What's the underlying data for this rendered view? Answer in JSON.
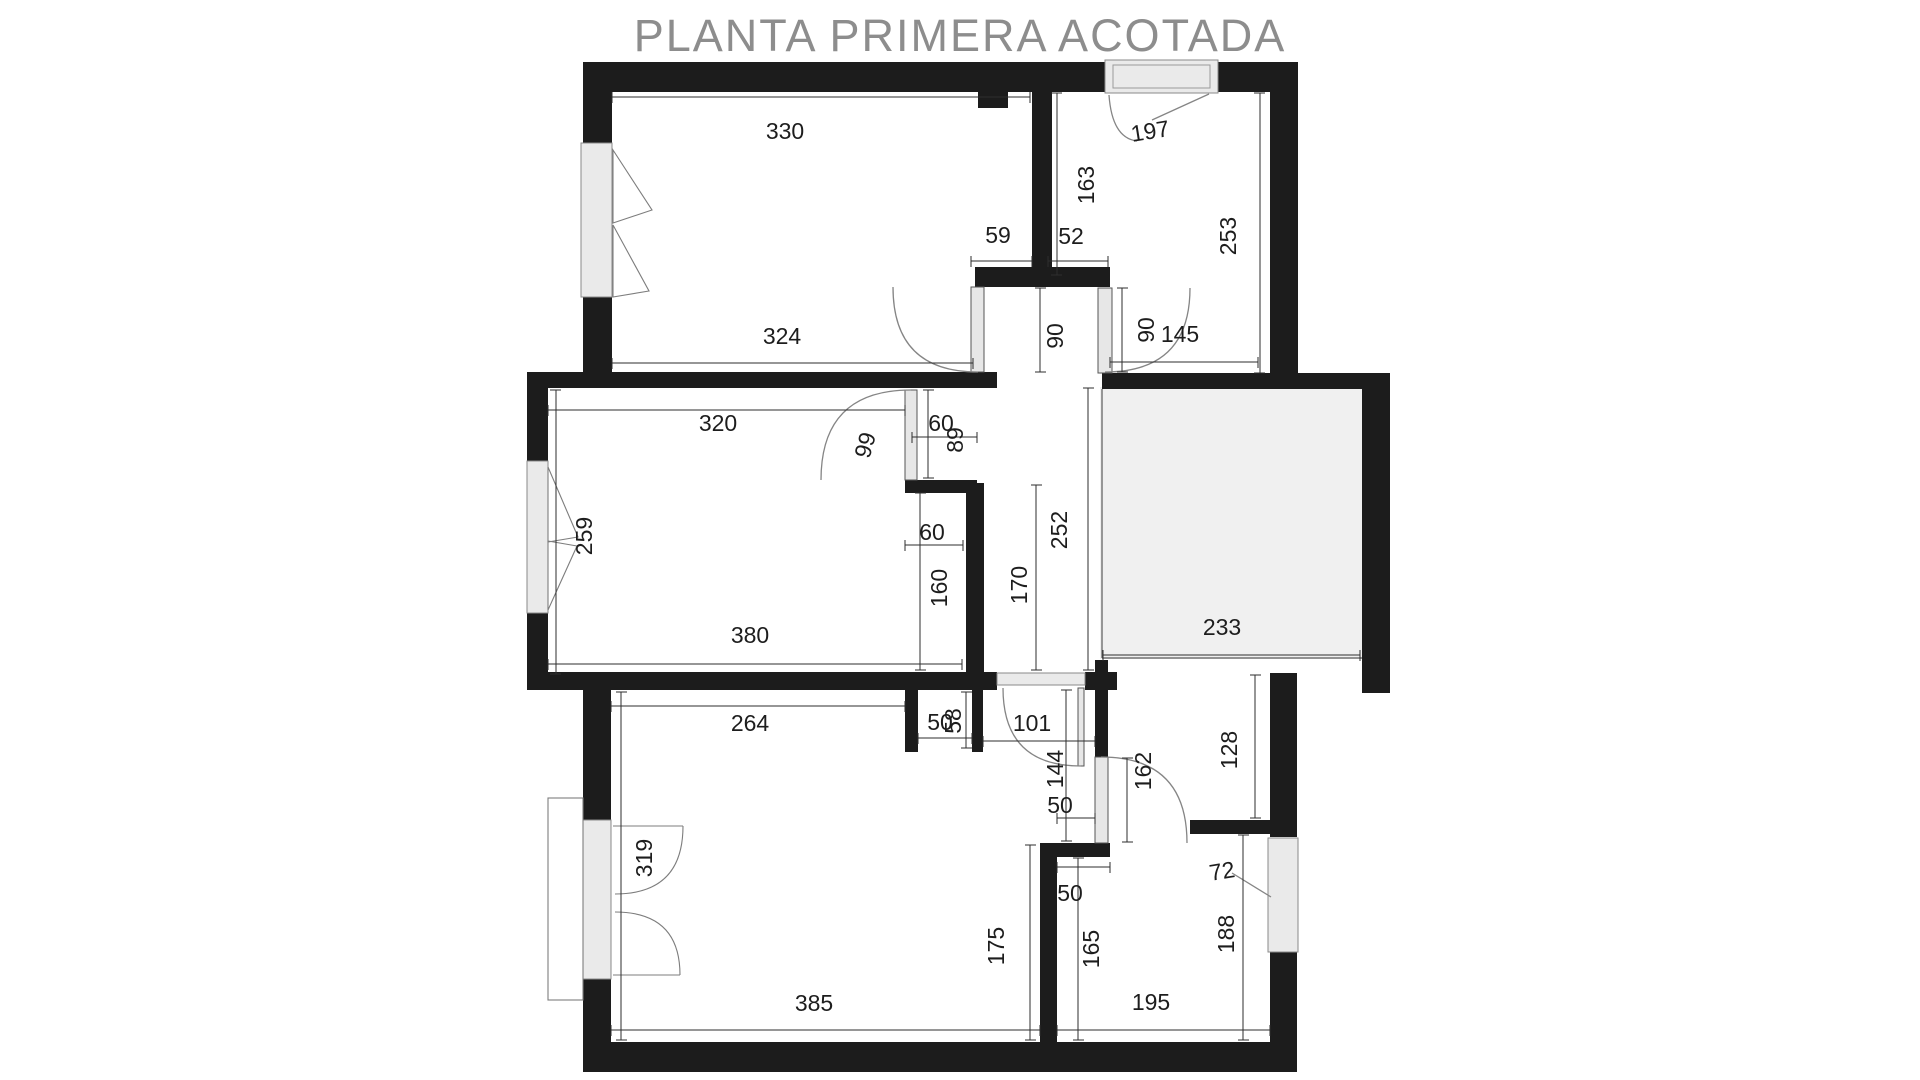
{
  "title": "PLANTA PRIMERA ACOTADA",
  "floorplan": {
    "unit": "cm",
    "labels": [
      {
        "value": "330"
      },
      {
        "value": "197"
      },
      {
        "value": "163"
      },
      {
        "value": "253"
      },
      {
        "value": "59"
      },
      {
        "value": "52"
      },
      {
        "value": "324"
      },
      {
        "value": "90"
      },
      {
        "value": "90"
      },
      {
        "value": "145"
      },
      {
        "value": "320"
      },
      {
        "value": "99"
      },
      {
        "value": "60"
      },
      {
        "value": "89"
      },
      {
        "value": "259"
      },
      {
        "value": "60"
      },
      {
        "value": "160"
      },
      {
        "value": "170"
      },
      {
        "value": "252"
      },
      {
        "value": "233"
      },
      {
        "value": "380"
      },
      {
        "value": "264"
      },
      {
        "value": "50"
      },
      {
        "value": "58"
      },
      {
        "value": "101"
      },
      {
        "value": "144"
      },
      {
        "value": "162"
      },
      {
        "value": "128"
      },
      {
        "value": "50"
      },
      {
        "value": "50"
      },
      {
        "value": "319"
      },
      {
        "value": "175"
      },
      {
        "value": "165"
      },
      {
        "value": "72"
      },
      {
        "value": "188"
      },
      {
        "value": "385"
      },
      {
        "value": "195"
      }
    ]
  }
}
